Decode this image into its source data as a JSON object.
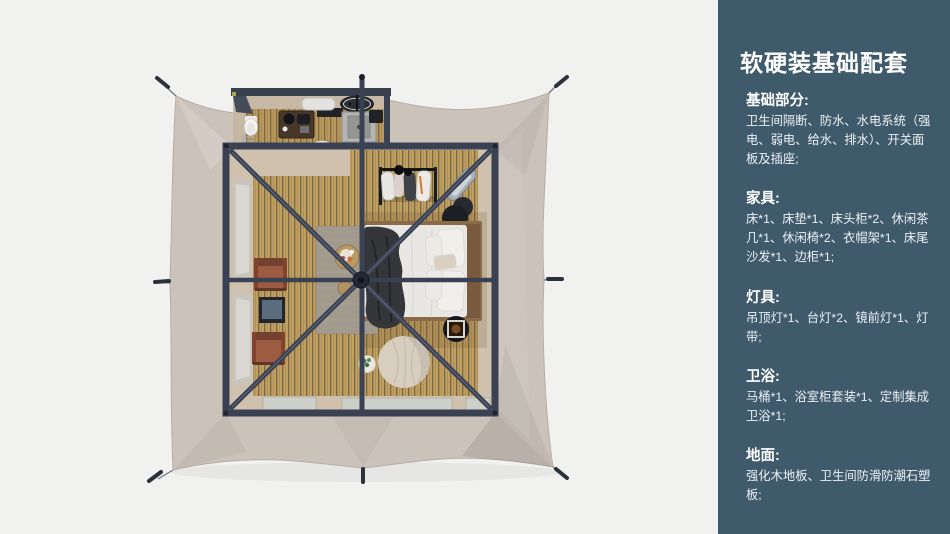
{
  "sidebar": {
    "title": "软硬装基础配套",
    "sections": [
      {
        "label": "基础部分:",
        "body": "卫生间隔断、防水、水电系统（强电、弱电、给水、排水）、开关面板及插座;"
      },
      {
        "label": "家具:",
        "body": "床*1、床垫*1、床头柜*2、休闲茶几*1、休闲椅*2、衣帽架*1、床尾沙发*1、边柜*1;"
      },
      {
        "label": "灯具:",
        "body": "吊顶灯*1、台灯*2、镜前灯*1、灯带;"
      },
      {
        "label": "卫浴:",
        "body": "马桶*1、浴室柜套装*1、定制集成卫浴*1;"
      },
      {
        "label": "地面:",
        "body": "强化木地板、卫生间防滑防潮石塑板;"
      }
    ]
  },
  "colors": {
    "page": "#f1f1f0",
    "sidebar": "#3e5a6b",
    "canvas": "#cbc2b9",
    "frame": "#3a4152",
    "wood": "#c09f63",
    "interior": "#cfc1ae",
    "rug": "#a29a8d",
    "chair": "#9d5b41",
    "pouf": "#d8cec0",
    "bedding": "#e9e7e3",
    "throw": "#35363a"
  }
}
